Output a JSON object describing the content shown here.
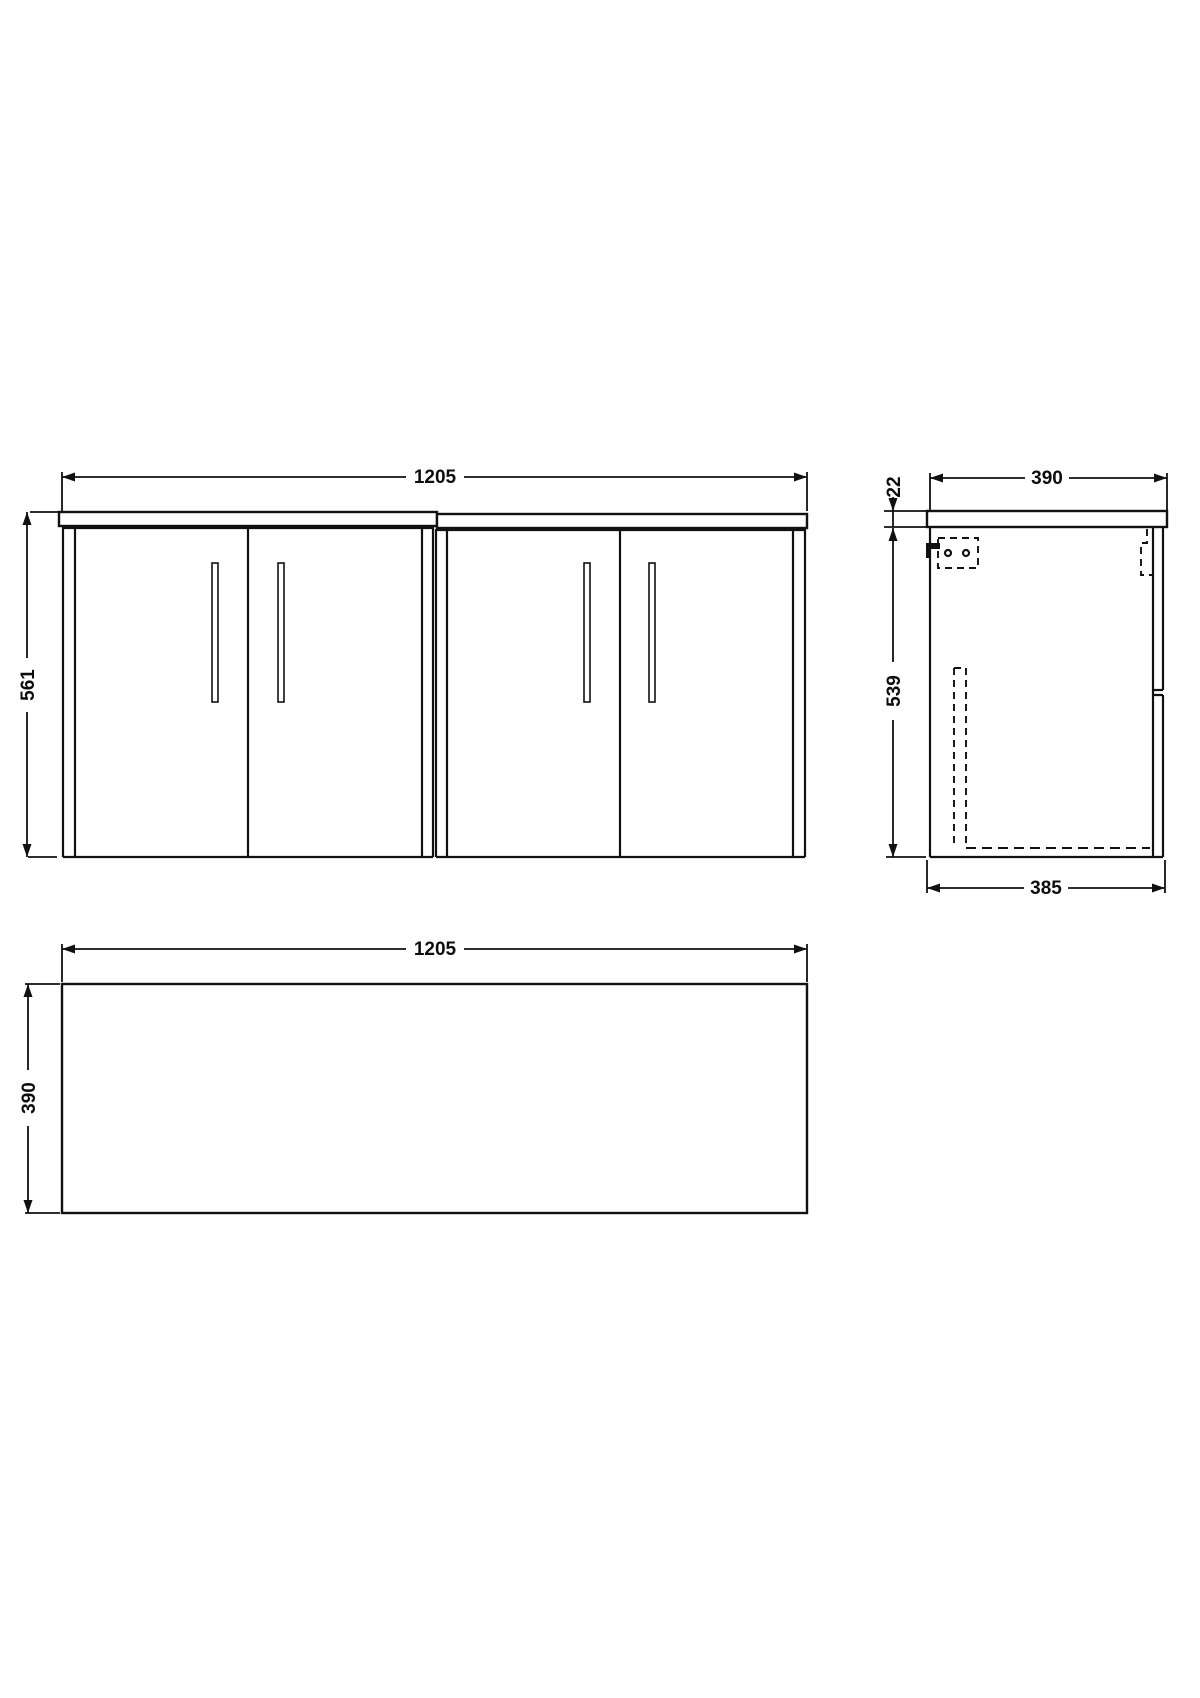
{
  "drawing": {
    "type": "furniture-dimension-drawing",
    "views": {
      "front": {
        "width": "1205",
        "height": "561"
      },
      "side": {
        "depth": "390",
        "worktop_thickness": "22",
        "carcass_height": "539",
        "carcass_depth": "385"
      },
      "plan": {
        "width": "1205",
        "depth": "390"
      }
    },
    "colors": {
      "line": "#111111",
      "background": "#ffffff"
    }
  }
}
